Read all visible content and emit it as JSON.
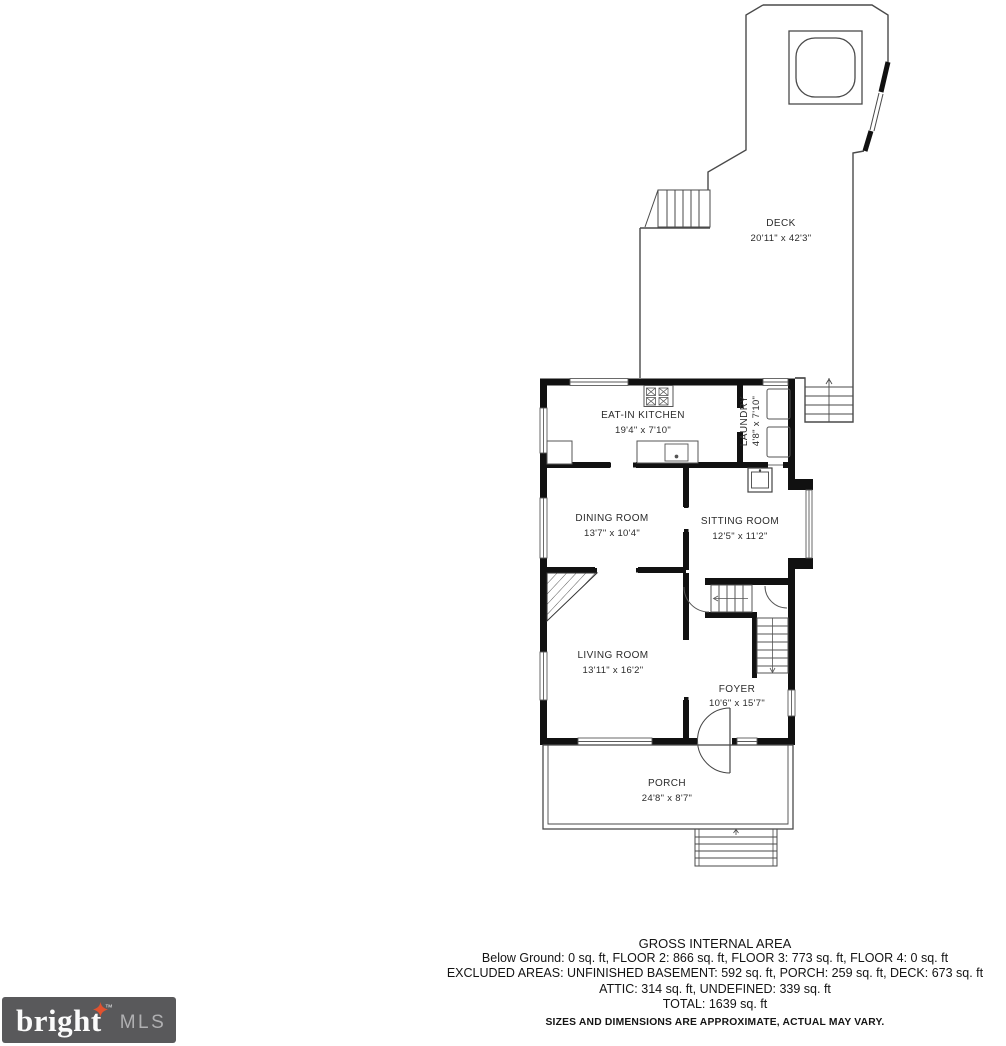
{
  "rooms": {
    "deck": {
      "name": "DECK",
      "dims": "20'11\" x 42'3\""
    },
    "kitchen": {
      "name": "EAT-IN KITCHEN",
      "dims": "19'4\" x 7'10\""
    },
    "laundry": {
      "name": "LAUNDRY",
      "dims": "4'8\" x 7'10\""
    },
    "dining": {
      "name": "DINING ROOM",
      "dims": "13'7\" x 10'4\""
    },
    "sitting": {
      "name": "SITTING ROOM",
      "dims": "12'5\" x 11'2\""
    },
    "living": {
      "name": "LIVING ROOM",
      "dims": "13'11\" x 16'2\""
    },
    "foyer": {
      "name": "FOYER",
      "dims": "10'6\" x 15'7\""
    },
    "porch": {
      "name": "PORCH",
      "dims": "24'8\" x 8'7\""
    }
  },
  "summary": {
    "title": "GROSS INTERNAL AREA",
    "line1": "Below Ground: 0 sq. ft, FLOOR 2: 866 sq. ft, FLOOR 3: 773 sq. ft, FLOOR 4: 0 sq. ft",
    "line2": "EXCLUDED AREAS: UNFINISHED BASEMENT: 592 sq. ft, PORCH: 259 sq. ft, DECK: 673 sq. ft",
    "line3": "ATTIC: 314 sq. ft, UNDEFINED: 339 sq. ft",
    "line4": "TOTAL: 1639 sq. ft",
    "disclaimer": "SIZES AND DIMENSIONS ARE APPROXIMATE, ACTUAL MAY VARY."
  },
  "logo": {
    "brand_head": "brigh",
    "brand_tail": "t",
    "tm": "™",
    "suffix": "MLS"
  },
  "colors": {
    "wall": "#111111",
    "line": "#4a4a4a",
    "logo_bg": "#59595b",
    "star": "#e0522f"
  }
}
